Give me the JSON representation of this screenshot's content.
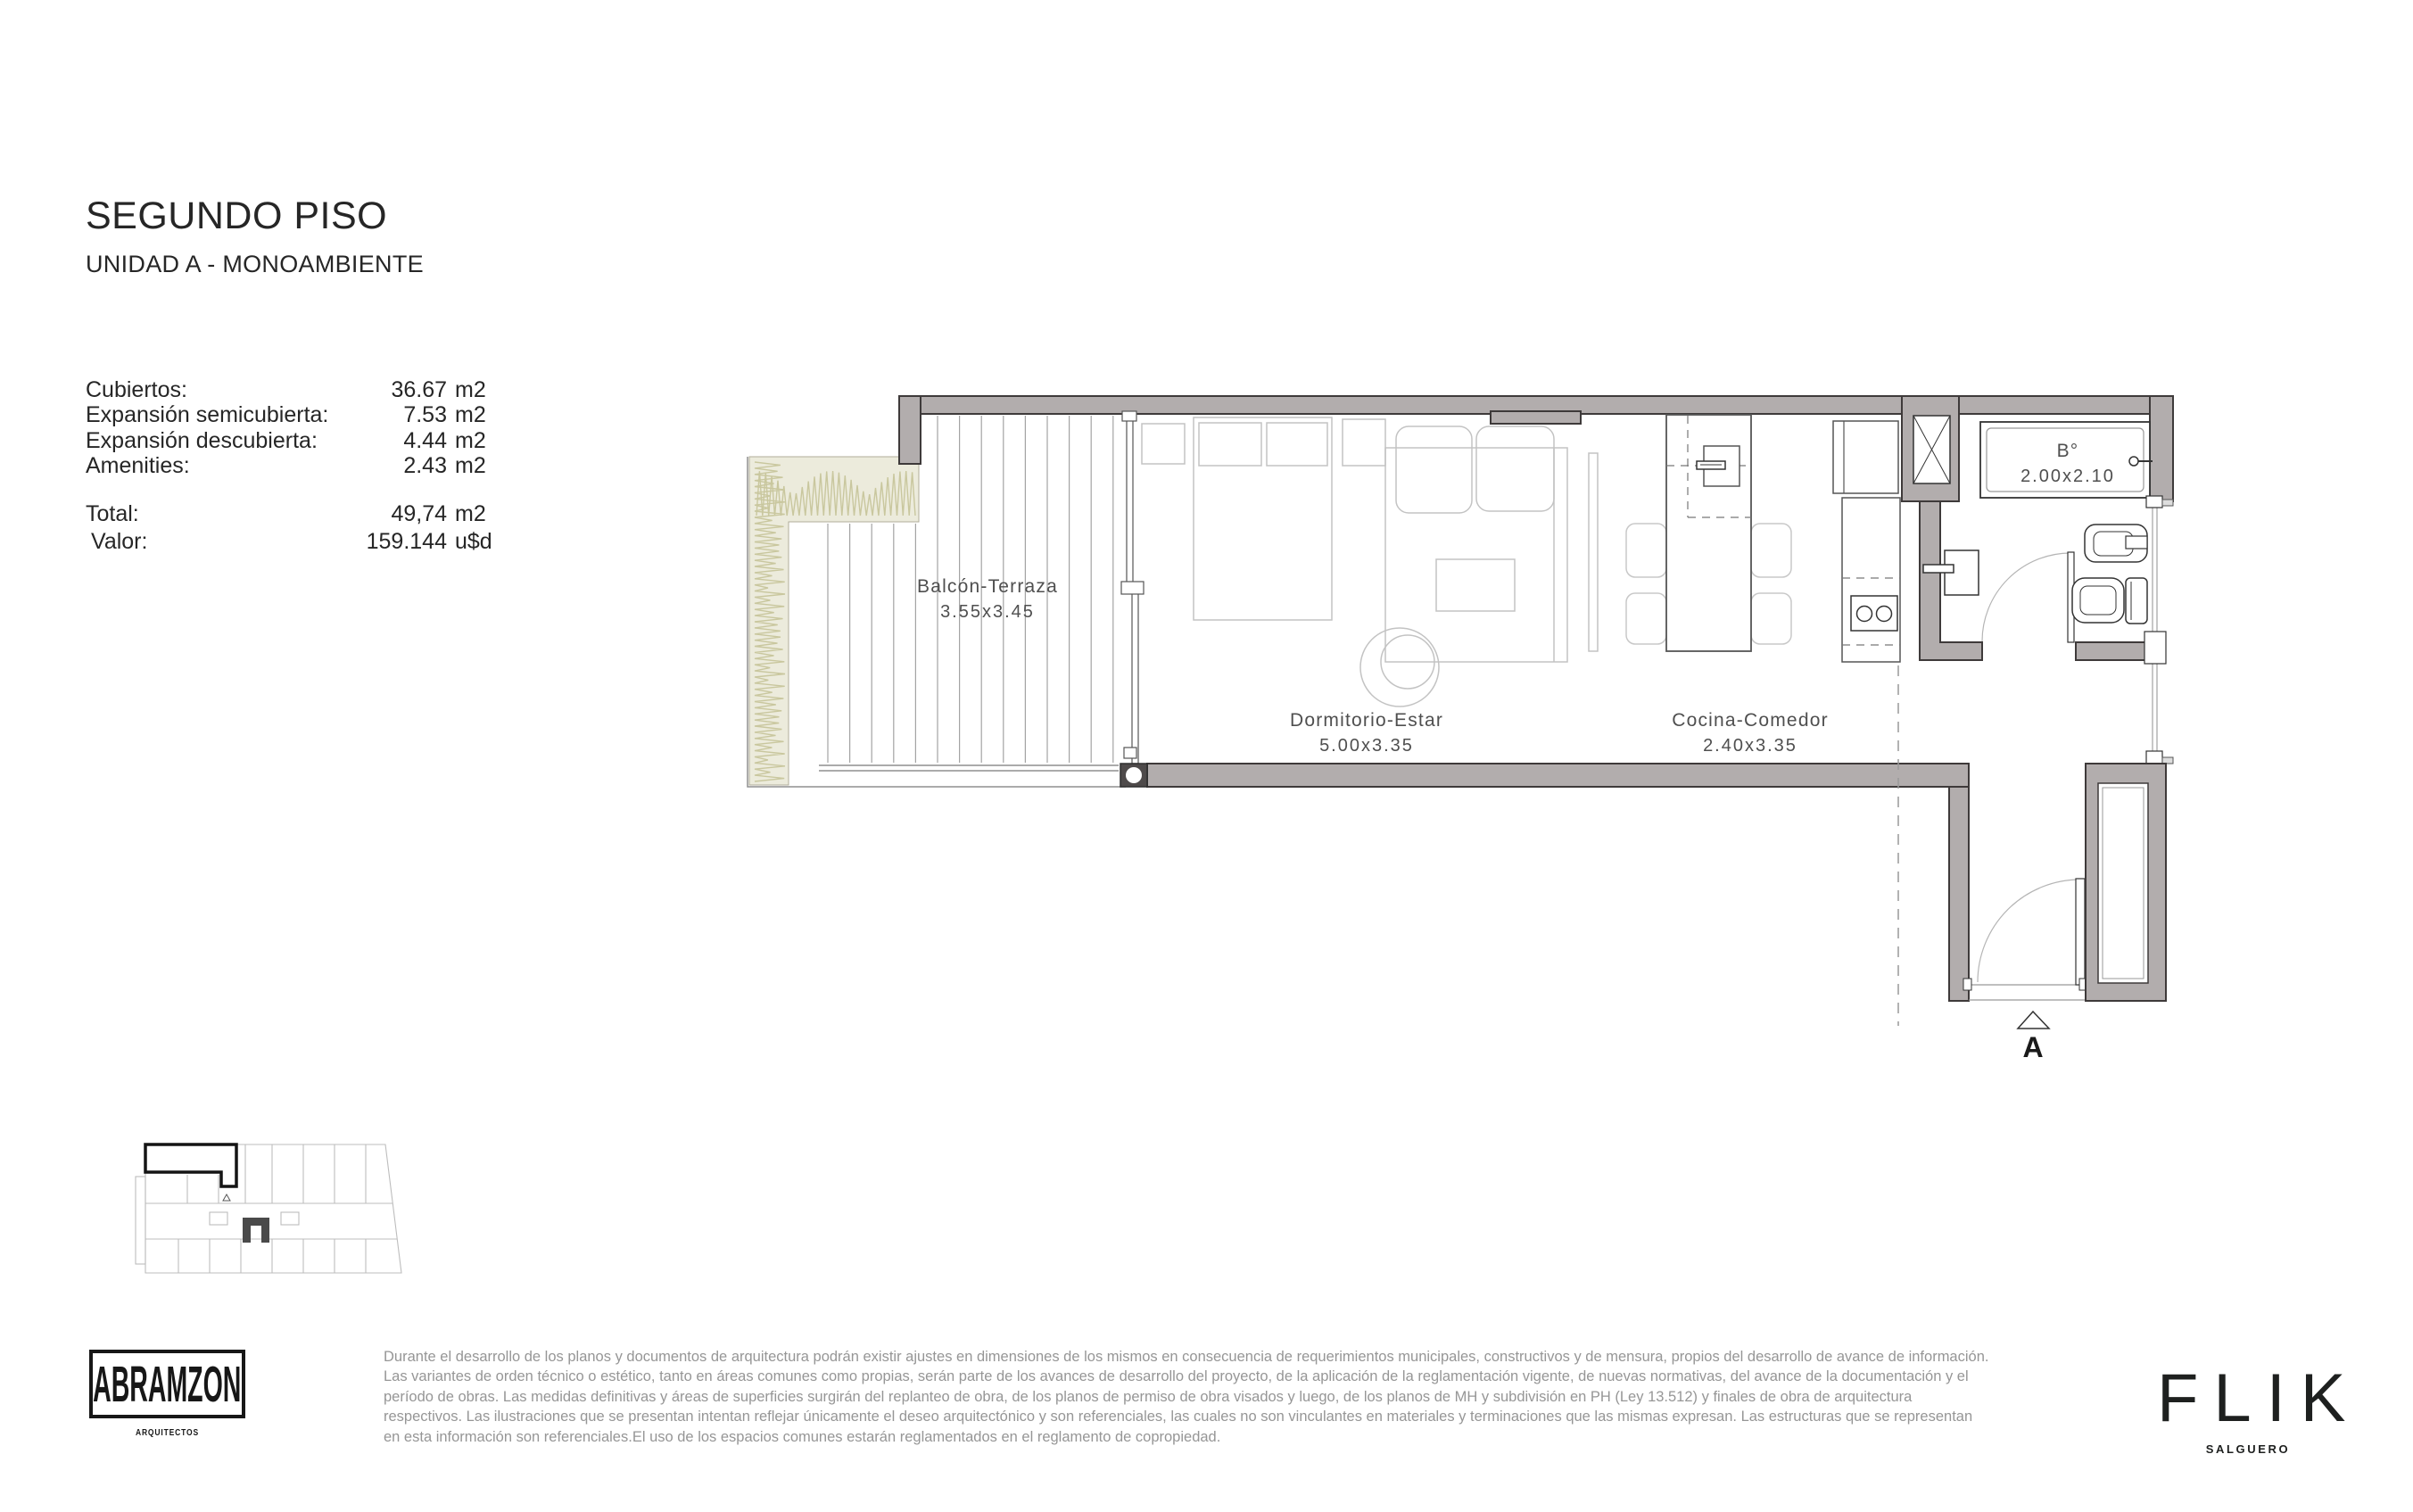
{
  "header": {
    "title": "SEGUNDO PISO",
    "subtitle": "UNIDAD A - MONOAMBIENTE"
  },
  "area_table": {
    "rows": [
      {
        "label": "Cubiertos:",
        "value": "36.67",
        "unit": "m2"
      },
      {
        "label": "Expansión semicubierta:",
        "value": "7.53",
        "unit": "m2"
      },
      {
        "label": "Expansión descubierta:",
        "value": "4.44",
        "unit": "m2"
      },
      {
        "label": "Amenities:",
        "value": "2.43",
        "unit": "m2"
      }
    ],
    "total": {
      "label": "Total:",
      "value": "49,74",
      "unit": "m2"
    },
    "valor": {
      "label": "Valor:",
      "value": "159.144",
      "unit": "u$d"
    }
  },
  "floor_plan": {
    "rooms": [
      {
        "name": "Balcón-Terraza",
        "dims": "3.55x3.45"
      },
      {
        "name": "Dormitorio-Estar",
        "dims": "5.00x3.35"
      },
      {
        "name": "Cocina-Comedor",
        "dims": "2.40x3.35"
      },
      {
        "name": "B°",
        "dims": "2.00x2.10"
      }
    ],
    "section_marker": "A"
  },
  "footer": {
    "disclaimer_lines": [
      "Durante el desarrollo de los planos y documentos de arquitectura podrán existir ajustes en dimensiones de los mismos en consecuencia de requerimientos municipales, constructivos y de mensura, propios del desarrollo de avance de información.",
      "Las variantes de orden técnico o estético, tanto en áreas comunes como propias, serán parte de los avances de desarrollo del proyecto, de la aplicación de la reglamentación vigente, de nuevas normativas,  del avance de la documentación y el",
      "período de obras. Las medidas definitivas y áreas de superficies surgirán del replanteo de obra, de los planos de permiso de obra visados y luego, de los planos de MH y subdivisión en PH (Ley 13.512) y finales de obra de arquitectura",
      "respectivos. Las ilustraciones que se presentan intentan reflejar únicamente el deseo arquitectónico y son referenciales, las cuales no son vinculantes en materiales y terminaciones que las mismas expresan. Las estructuras que se representan",
      "en esta información son referenciales.El uso de los espacios comunes estarán reglamentados en el reglamento de copropiedad."
    ],
    "architect_logo": {
      "name": "ABRAMZON",
      "tagline": "ARQUITECTOS"
    },
    "brand_logo": {
      "name": "FLIK",
      "tagline": "SALGUERO"
    }
  }
}
